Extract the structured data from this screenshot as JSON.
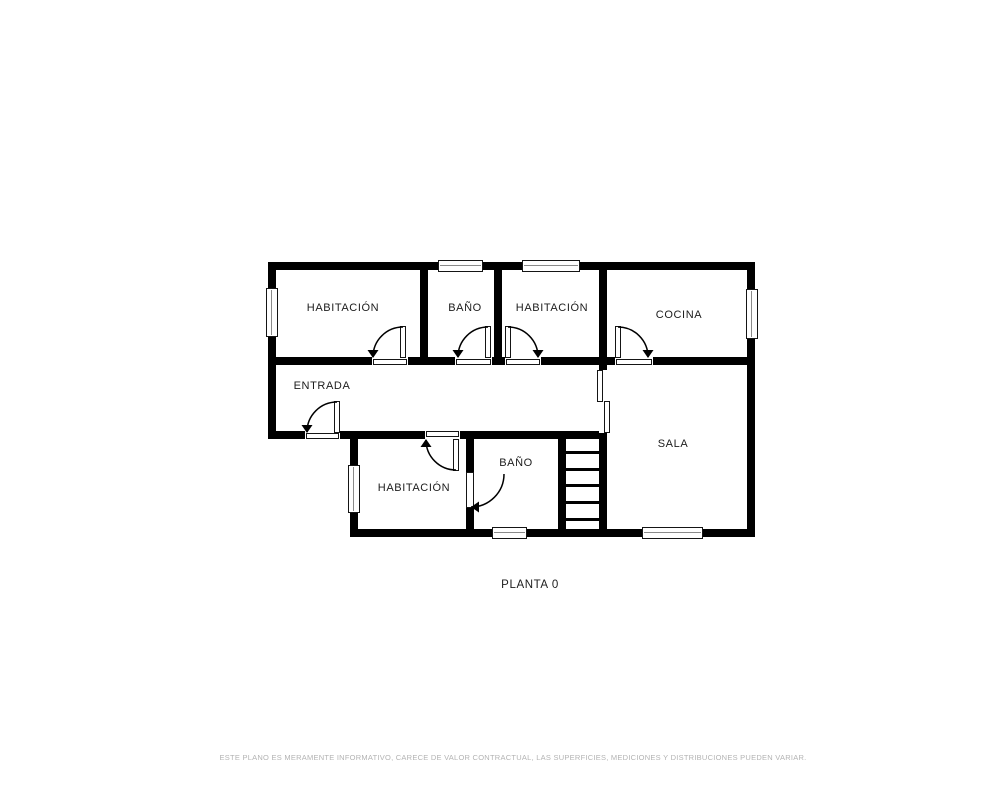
{
  "plan": {
    "title": "PLANTA 0",
    "rooms": [
      {
        "id": "habitacion-1",
        "label": "HABITACIÓN"
      },
      {
        "id": "bano-1",
        "label": "BAÑO"
      },
      {
        "id": "habitacion-2",
        "label": "HABITACIÓN"
      },
      {
        "id": "cocina",
        "label": "COCINA"
      },
      {
        "id": "entrada",
        "label": "ENTRADA"
      },
      {
        "id": "sala",
        "label": "SALA"
      },
      {
        "id": "habitacion-3",
        "label": "HABITACIÓN"
      },
      {
        "id": "bano-2",
        "label": "BAÑO"
      }
    ],
    "stairs_steps": 6,
    "window_count": 7,
    "door_count": 7,
    "sliding_door_count": 1,
    "disclaimer": "ESTE PLANO ES MERAMENTE INFORMATIVO, CARECE DE VALOR CONTRACTUAL, LAS SUPERFICIES, MEDICIONES Y DISTRIBUCIONES PUEDEN VARIAR."
  },
  "colors": {
    "background": "#ffffff",
    "wall": "#000000",
    "label_text": "#1c1c1c",
    "disclaimer_text": "#b3b3b3"
  }
}
